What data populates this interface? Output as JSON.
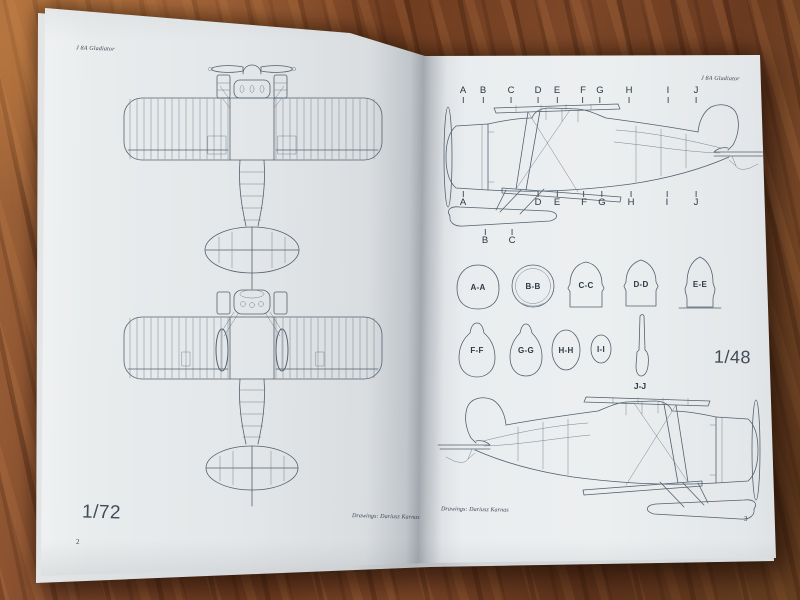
{
  "left_page": {
    "header": "J 8A Gladiator",
    "scale": "1/72",
    "credit": "Drawings: Dariusz Karnas",
    "page_number": "2"
  },
  "right_page": {
    "header": "J 8A Gladiator",
    "section_markers_top": [
      "A",
      "B",
      "C",
      "D",
      "E",
      "F",
      "G",
      "H",
      "I",
      "J"
    ],
    "section_markers_bottom_row1": [
      "A",
      "D",
      "E",
      "F",
      "G",
      "H",
      "I",
      "J"
    ],
    "section_markers_bottom_row2": [
      "B",
      "C"
    ],
    "cross_sections_row1": [
      "A-A",
      "B-B",
      "C-C",
      "D-D",
      "E-E"
    ],
    "cross_sections_row2": [
      "F-F",
      "G-G",
      "H-H",
      "I-I"
    ],
    "cross_section_propeller": "J-J",
    "scale": "1/48",
    "credit": "Drawings: Dariusz Karnas",
    "page_number": "3"
  }
}
